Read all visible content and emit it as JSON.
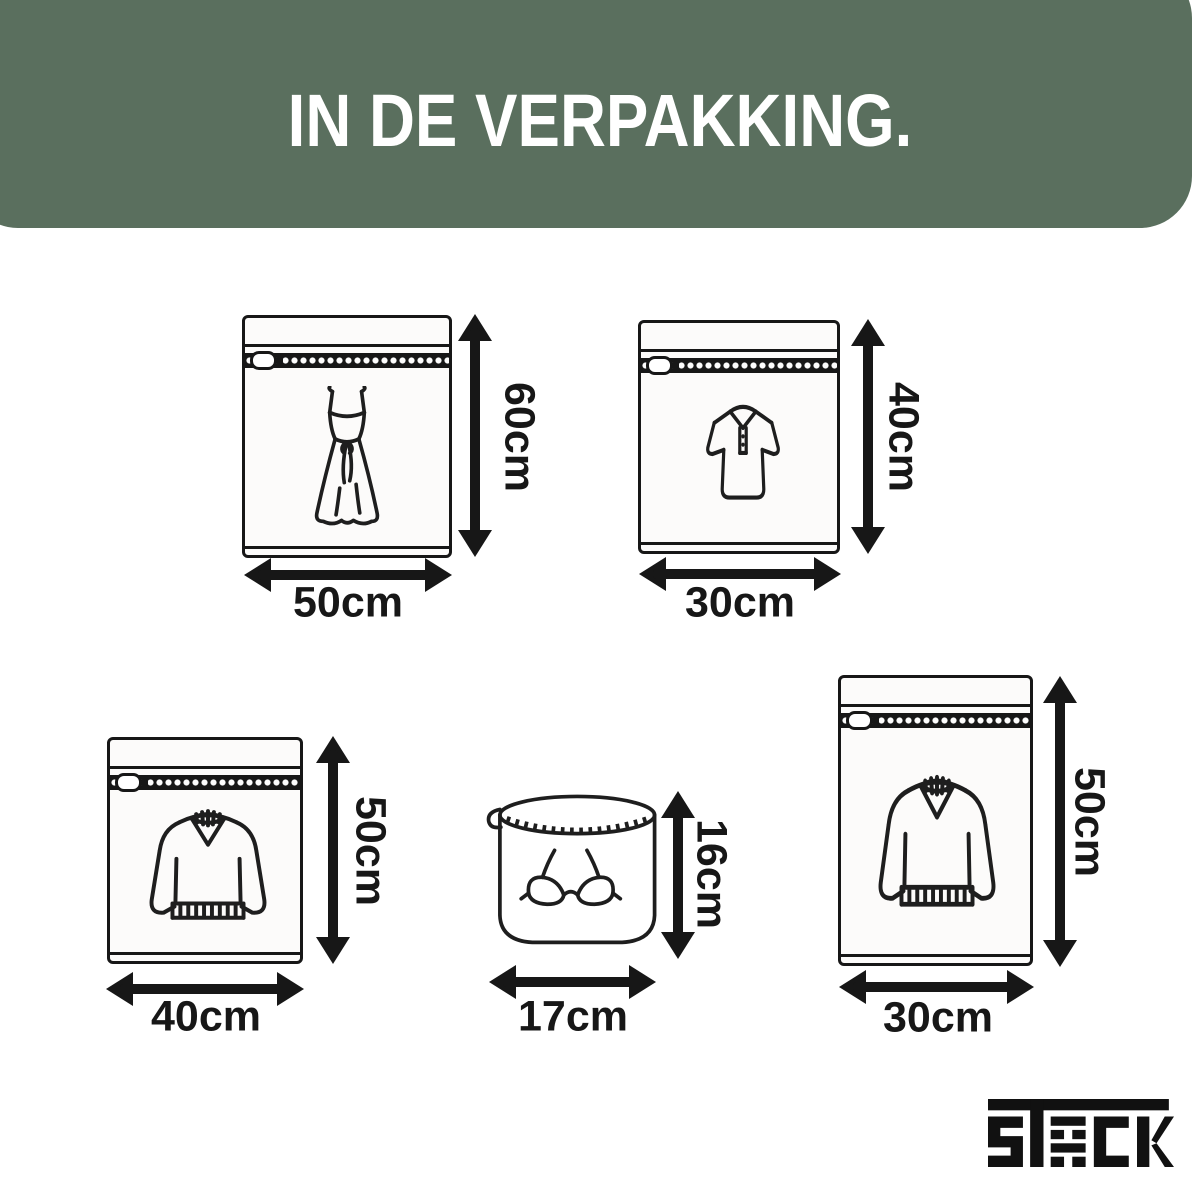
{
  "header": {
    "title": "IN DE VERPAKKING.",
    "background_color": "#5a6f5e",
    "text_color": "#ffffff"
  },
  "bags": [
    {
      "name": "dress wash bag",
      "icon": "dress-icon",
      "height_label": "60cm",
      "width_label": "50cm"
    },
    {
      "name": "polo shirt wash bag",
      "icon": "polo-shirt-icon",
      "height_label": "40cm",
      "width_label": "30cm"
    },
    {
      "name": "sweater wash bag large",
      "icon": "sweater-icon",
      "height_label": "50cm",
      "width_label": "40cm"
    },
    {
      "name": "bra wash bag round",
      "icon": "bra-icon",
      "height_label": "16cm",
      "width_label": "17cm"
    },
    {
      "name": "sweater wash bag tall",
      "icon": "sweater-icon",
      "height_label": "50cm",
      "width_label": "30cm"
    }
  ],
  "brand": {
    "logo_text": "STACK"
  }
}
